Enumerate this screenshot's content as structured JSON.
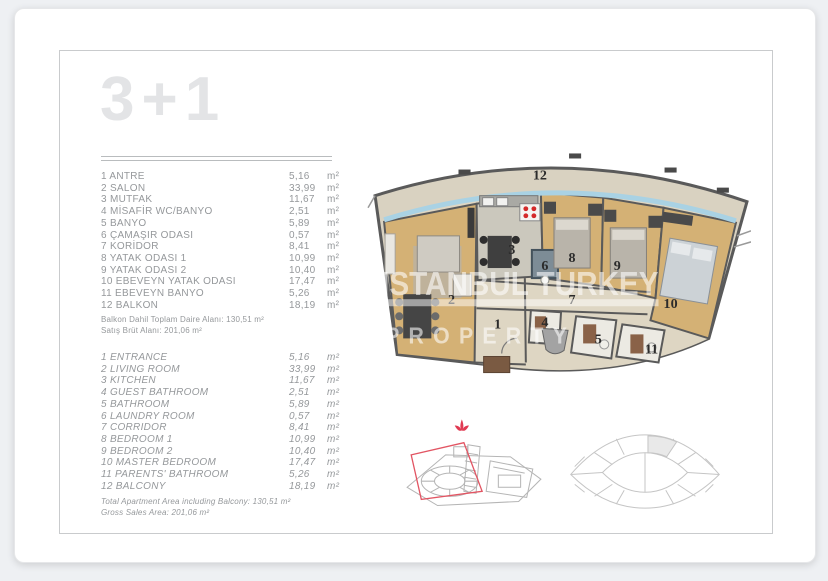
{
  "card": {
    "title": "3+1"
  },
  "list_tr": {
    "rows": [
      {
        "label": "1 ANTRE",
        "value": "5,16",
        "unit": "m²"
      },
      {
        "label": "2 SALON",
        "value": "33,99",
        "unit": "m²"
      },
      {
        "label": "3 MUTFAK",
        "value": "11,67",
        "unit": "m²"
      },
      {
        "label": "4 MİSAFİR WC/BANYO",
        "value": "2,51",
        "unit": "m²"
      },
      {
        "label": "5 BANYO",
        "value": "5,89",
        "unit": "m²"
      },
      {
        "label": "6 ÇAMAŞIR ODASI",
        "value": "0,57",
        "unit": "m²"
      },
      {
        "label": "7 KORİDOR",
        "value": "8,41",
        "unit": "m²"
      },
      {
        "label": "8 YATAK ODASI 1",
        "value": "10,99",
        "unit": "m²"
      },
      {
        "label": "9 YATAK ODASI 2",
        "value": "10,40",
        "unit": "m²"
      },
      {
        "label": "10 EBEVEYN YATAK ODASI",
        "value": "17,47",
        "unit": "m²"
      },
      {
        "label": "11 EBEVEYN BANYO",
        "value": "5,26",
        "unit": "m²"
      },
      {
        "label": "12 BALKON",
        "value": "18,19",
        "unit": "m²"
      }
    ],
    "total_lines": [
      "Balkon Dahil Toplam Daire Alanı: 130,51 m²",
      "Satış Brüt Alanı: 201,06 m²"
    ]
  },
  "list_en": {
    "rows": [
      {
        "label": "1 ENTRANCE",
        "value": "5,16",
        "unit": "m²"
      },
      {
        "label": "2 LIVING ROOM",
        "value": "33,99",
        "unit": "m²"
      },
      {
        "label": "3 KITCHEN",
        "value": "11,67",
        "unit": "m²"
      },
      {
        "label": "4 GUEST BATHROOM",
        "value": "2,51",
        "unit": "m²"
      },
      {
        "label": "5 BATHROOM",
        "value": "5,89",
        "unit": "m²"
      },
      {
        "label": "6 LAUNDRY ROOM",
        "value": "0,57",
        "unit": "m²"
      },
      {
        "label": "7 CORRIDOR",
        "value": "8,41",
        "unit": "m²"
      },
      {
        "label": "8 BEDROOM 1",
        "value": "10,99",
        "unit": "m²"
      },
      {
        "label": "9 BEDROOM 2",
        "value": "10,40",
        "unit": "m²"
      },
      {
        "label": "10 MASTER BEDROOM",
        "value": "17,47",
        "unit": "m²"
      },
      {
        "label": "11 PARENTS' BATHROOM",
        "value": "5,26",
        "unit": "m²"
      },
      {
        "label": "12 BALCONY",
        "value": "18,19",
        "unit": "m²"
      }
    ],
    "total_lines": [
      "Total Apartment Area including Balcony: 130,51 m²",
      "Gross Sales Area: 201,06 m²"
    ]
  },
  "plan": {
    "room_numbers": [
      "1",
      "2",
      "3",
      "4",
      "5",
      "6",
      "7",
      "8",
      "9",
      "10",
      "11",
      "12"
    ],
    "watermark_line1": "ISTANBUL TURKEY",
    "watermark_line2": "PROPERTY"
  },
  "colors": {
    "wood_floor": "#d4b175",
    "balcony_floor": "#d9d2c1",
    "wall": "#5a5a5a",
    "glazing_blue": "#a9d2e4",
    "corridor_floor": "#ded6c3",
    "bathroom_floor": "#eceae3",
    "accent_red": "#e04a5a",
    "title_gray": "#e3e4e6",
    "text_gray": "#95989b"
  }
}
